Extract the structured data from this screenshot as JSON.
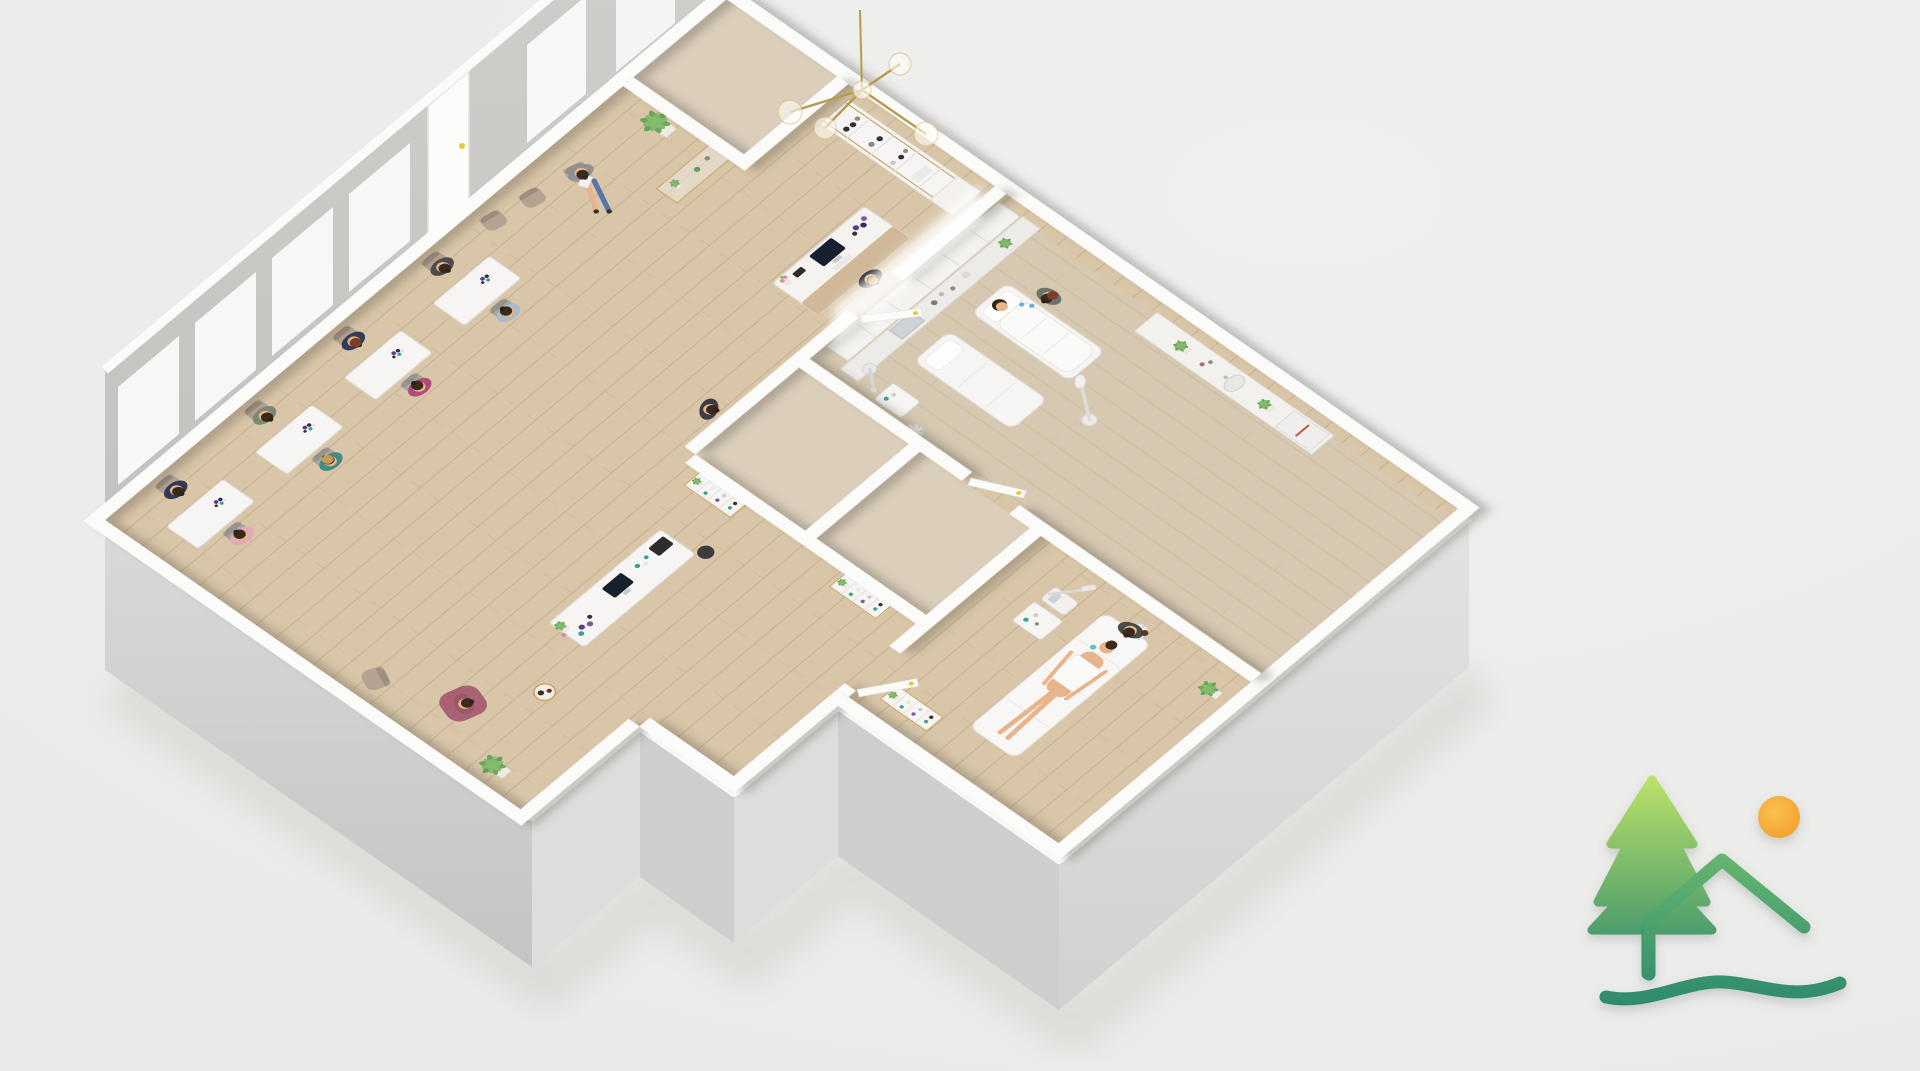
{
  "meta": {
    "type": "3d-floorplan-cutaway-render",
    "subject": "beauty salon and spa interior, isometric top-down view",
    "text_visible": "none"
  },
  "colors": {
    "bg": "#eaeae8",
    "bg_hi": "#efefed",
    "facade_light": "#dedddb",
    "facade_mid": "#cfcecc",
    "facade_dark": "#c3c2c0",
    "wall_top": "#fbfbfa",
    "wall_face": "#c9c7c4",
    "window_white": "#f7f7f5",
    "wood": "#d9c6a8",
    "wood_line": "#b89b78",
    "wood_alt": "#d7c8b2",
    "wood_small": "#dbcfbb",
    "gold": "#c2a35c",
    "green_dark": "#5f9e55",
    "green_light": "#84bb6a",
    "skin": "#e7b48c",
    "furn_white": "#f6f5f3",
    "furn_stroke": "#e2dfda",
    "chair_taupe": "#b5a292",
    "chair_gray": "#a9a7a3",
    "screen_dark": "#16202e",
    "purple": "#5d3c8f",
    "purple_light": "#7e57a8",
    "teal": "#3f9d92",
    "bottle_dark": "#35322f",
    "handle_yellow": "#e7c63f",
    "logo_green_light": "#b9e069",
    "logo_green_mid": "#67b76e",
    "logo_teal": "#2e8a6d",
    "sun_light": "#fbc14f",
    "sun_dark": "#f09c2e"
  },
  "scene": {
    "building": {
      "style": "white-topped cutaway walls, gray exterior facades, light oak plank floors",
      "window_wall": [
        "window",
        "window",
        "window",
        "window",
        "entry-door-with-yellow-handle",
        "window",
        "white-panel"
      ]
    },
    "rooms": [
      {
        "name": "nail-salon",
        "contents": [
          "4 white manicure stations with product bottles",
          "4 nail technicians",
          "4 seated clients",
          "computer workstation desk with iMac, retail bottles, plant and black printer",
          "dark office chair",
          "pink lounge armchair with seated reader",
          "taupe accent chair",
          "round gold side table",
          "potted plant"
        ]
      },
      {
        "name": "reception-lounge",
        "contents": [
          "3 taupe waiting chairs",
          "client reading magazine",
          "potted palm on stand",
          "gold console table with plants",
          "gold globe chandelier",
          "wall retail shelving with dark bottles",
          "white-and-wood reception desk with iMac, flower vase and purple bottles",
          "standing receptionist",
          "standing visitor in dark clothes"
        ]
      },
      {
        "name": "hallway-and-storage",
        "contents": [
          "two small storage rooms",
          "corner closet",
          "gold etagere shelves with plants, teal and purple products",
          "white doors with yellow handles"
        ]
      },
      {
        "name": "facial-treatment-room-right",
        "contents": [
          "wall cabinets with light strip",
          "equipment counter with steel sterilizer and tools",
          "facial steamer",
          "white trolley cart",
          "rolling stool",
          "magnifying lamp",
          "empty treatment bed with pillow",
          "treatment bed with reclined client under white blanket",
          "esthetician with blue gloves",
          "sink counter with plant, bottles and towel warmer"
        ]
      },
      {
        "name": "treatment-room-bottom",
        "contents": [
          "treatment bed with reclined client wrapped in white towel",
          "seated esthetician on rolling stool",
          "white trolley with supplies",
          "facial machine with articulated arm",
          "gold shelf with plants",
          "floor plant"
        ]
      }
    ],
    "people_count": 16,
    "people": [
      {
        "role": "nail-tech",
        "top": "#2f3b55"
      },
      {
        "role": "client",
        "top": "#e3a9b4"
      },
      {
        "role": "nail-tech",
        "top": "#78897a"
      },
      {
        "role": "client",
        "top": "#3f8e86"
      },
      {
        "role": "nail-tech",
        "top": "#333d57"
      },
      {
        "role": "client",
        "top": "#b34a7e"
      },
      {
        "role": "nail-tech",
        "top": "#4c4c4f"
      },
      {
        "role": "client",
        "top": "#a9bccb"
      },
      {
        "role": "waiting-client-reading",
        "top": "#8d9196"
      },
      {
        "role": "lounge-client",
        "top": "#9d5868"
      },
      {
        "role": "receptionist",
        "top": "#26262a"
      },
      {
        "role": "standing-visitor",
        "top": "#3c3c44"
      },
      {
        "role": "esthetician",
        "top": "#6e7268"
      },
      {
        "role": "facial-client",
        "top": "skin"
      },
      {
        "role": "esthetician",
        "top": "#474b43"
      },
      {
        "role": "body-treatment-client",
        "top": "skin"
      }
    ]
  },
  "logo": {
    "name": "landscape-logo",
    "elements": [
      "pine-tree",
      "roofline-mountain",
      "sun",
      "wave-underline"
    ]
  }
}
